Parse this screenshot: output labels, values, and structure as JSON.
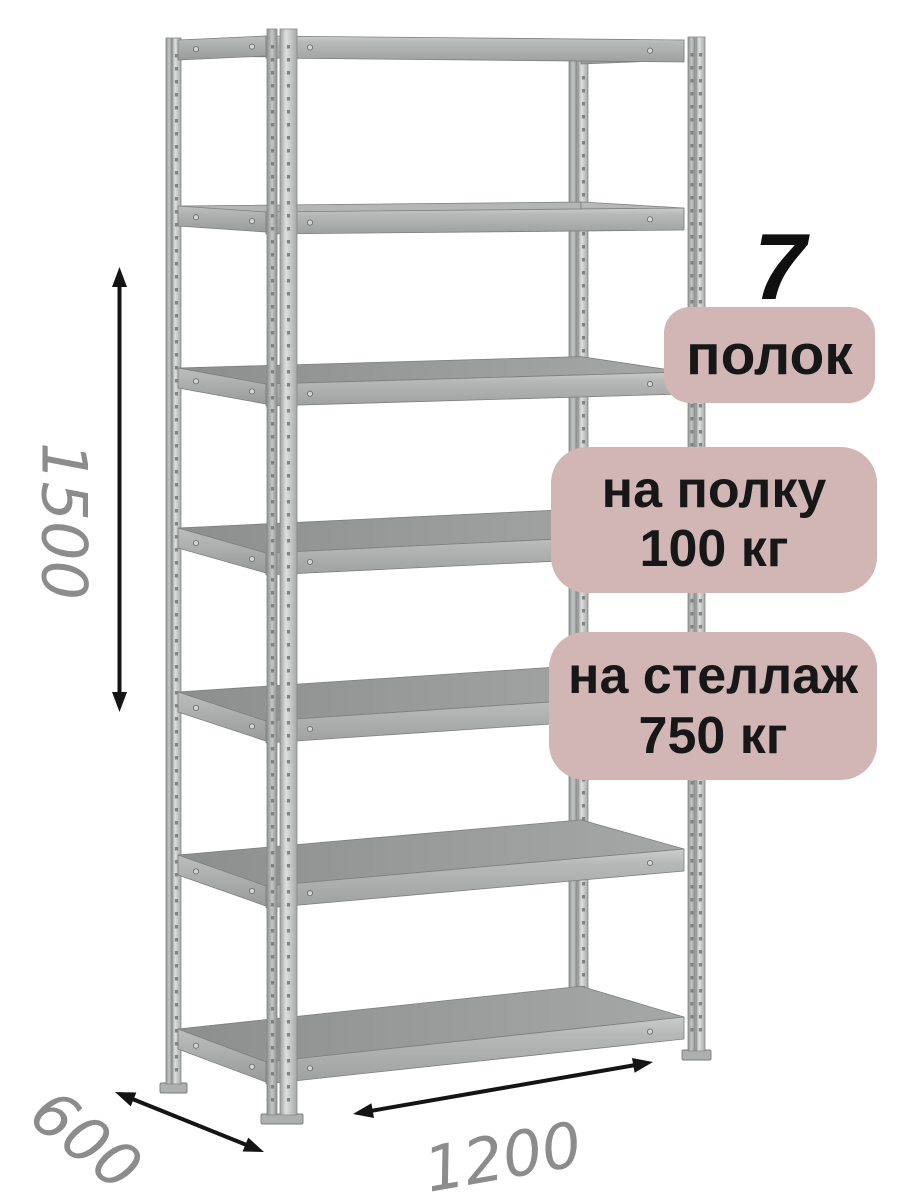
{
  "figure": {
    "kind": "product-dimension-diagram",
    "subject": "metal-shelving-rack",
    "shelves": 7
  },
  "callouts": {
    "count": "7",
    "count_label": "полок",
    "shelf_load_line1": "на полку",
    "shelf_load_line2": "100 кг",
    "rack_load_line1": "на стеллаж",
    "rack_load_line2": "750 кг"
  },
  "dimensions": {
    "height": "1500",
    "depth": "600",
    "width": "1200"
  },
  "colors": {
    "background": "#ffffff",
    "badge_bg": "#d2b6b6",
    "badge_text": "#171717",
    "count_text": "#0f0f0f",
    "dim_text": "#8c8c8c",
    "arrow": "#141414",
    "metal_light": "#d6d6d6",
    "metal_mid": "#b5b7b7",
    "metal_dark": "#9a9c9c"
  }
}
